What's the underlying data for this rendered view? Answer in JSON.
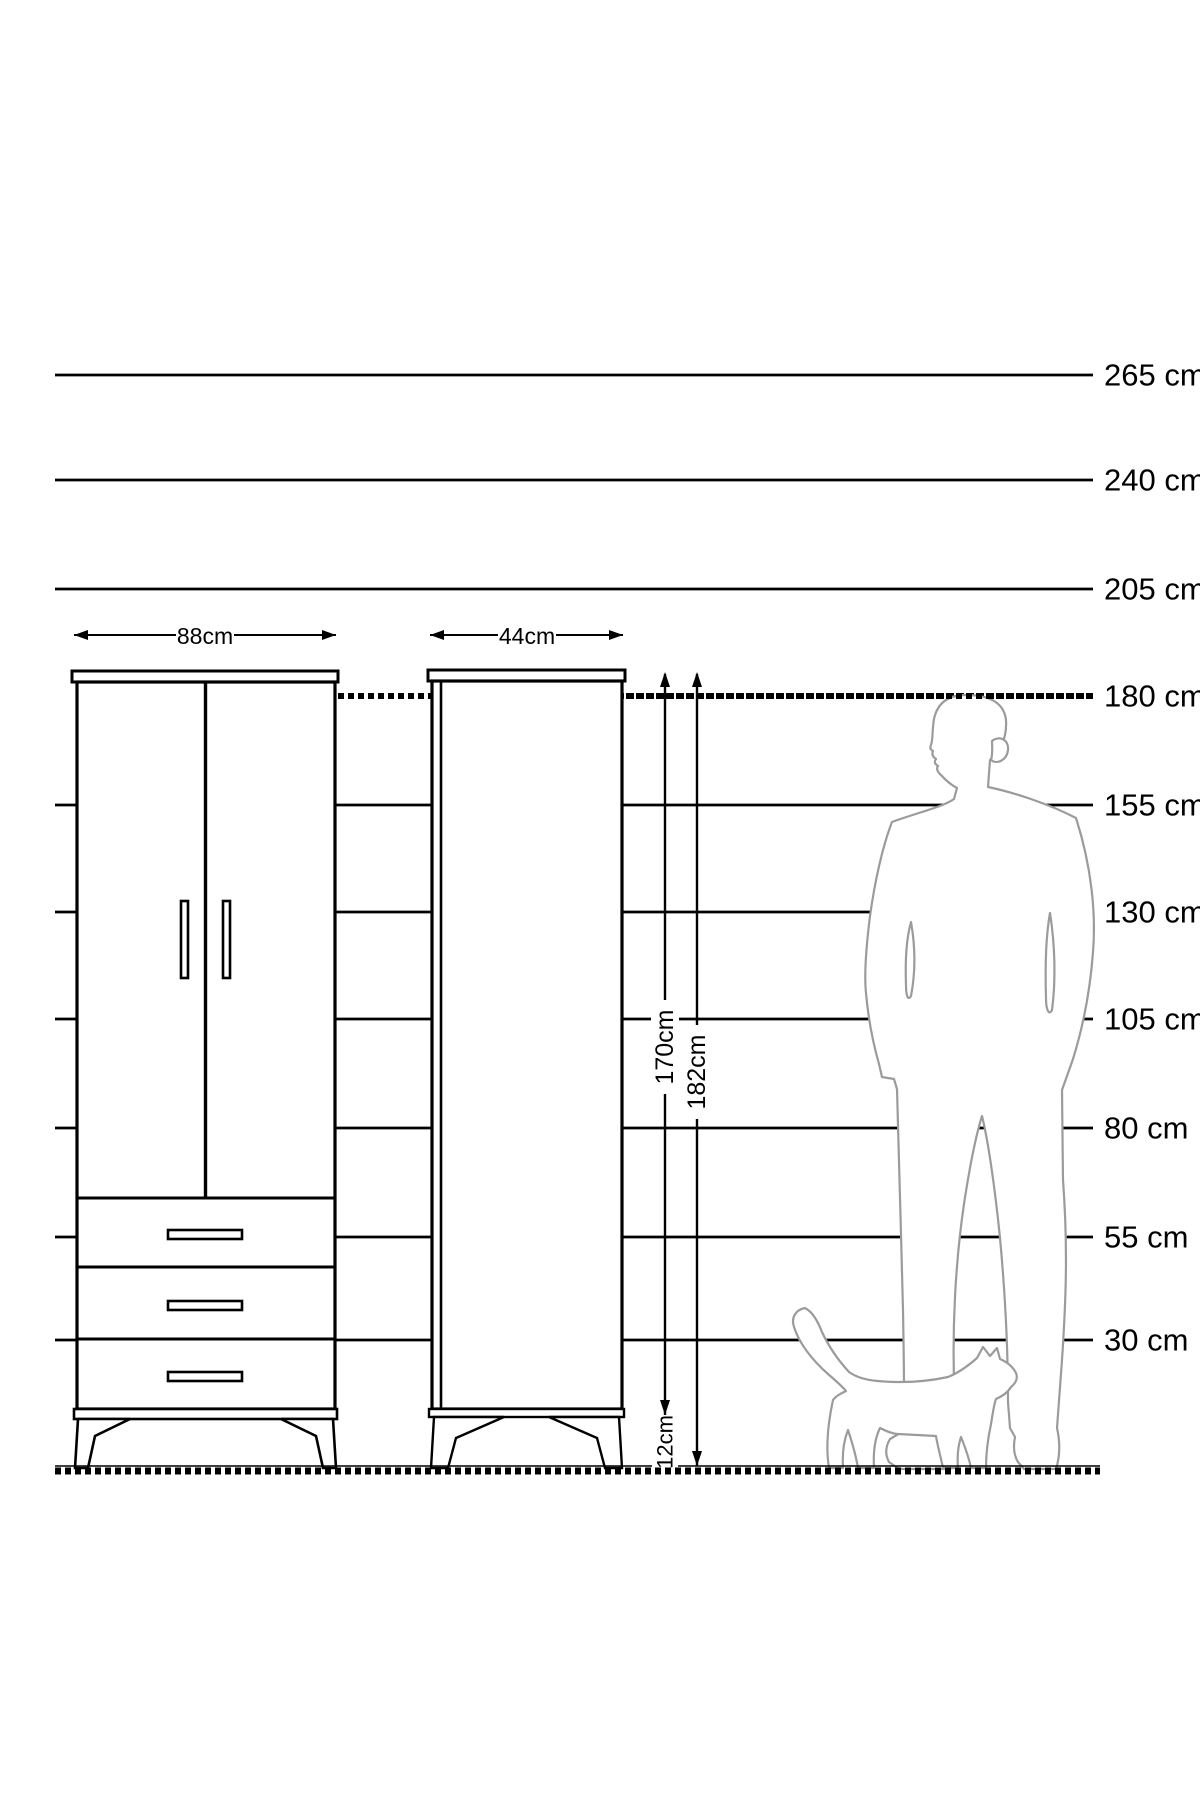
{
  "diagram": {
    "type": "furniture-dimension-drawing",
    "unit": "cm",
    "ruler": {
      "x_start": 55,
      "x_end": 1093,
      "label_x": 1104,
      "lines": [
        {
          "label": "265 cm",
          "value_cm": 265,
          "y": 375,
          "style": "solid"
        },
        {
          "label": "240 cm",
          "value_cm": 240,
          "y": 480,
          "style": "solid"
        },
        {
          "label": "205 cm",
          "value_cm": 205,
          "y": 589,
          "style": "solid"
        },
        {
          "label": "180 cm",
          "value_cm": 180,
          "y": 696,
          "style": "hatched",
          "x_start": 338
        },
        {
          "label": "155 cm",
          "value_cm": 155,
          "y": 805,
          "style": "solid"
        },
        {
          "label": "130 cm",
          "value_cm": 130,
          "y": 912,
          "style": "solid"
        },
        {
          "label": "105 cm",
          "value_cm": 105,
          "y": 1019,
          "style": "solid"
        },
        {
          "label": "80 cm",
          "value_cm": 80,
          "y": 1128,
          "style": "solid"
        },
        {
          "label": "55 cm",
          "value_cm": 55,
          "y": 1237,
          "style": "solid"
        },
        {
          "label": "30 cm",
          "value_cm": 30,
          "y": 1340,
          "style": "solid"
        }
      ]
    },
    "dimensions": {
      "wardrobe_width": "88cm",
      "cabinet_width": "44cm",
      "body_height": "170cm",
      "total_height": "182cm",
      "leg_height": "12cm"
    },
    "floor": {
      "y": 1470,
      "x_start": 55,
      "x_end": 1100,
      "style": "hatched"
    },
    "figures": {
      "man": "man-silhouette",
      "cat": "cat-silhouette"
    },
    "colors": {
      "ink": "#000000",
      "silhouette": "#9b9b9b",
      "background": "#ffffff"
    }
  }
}
